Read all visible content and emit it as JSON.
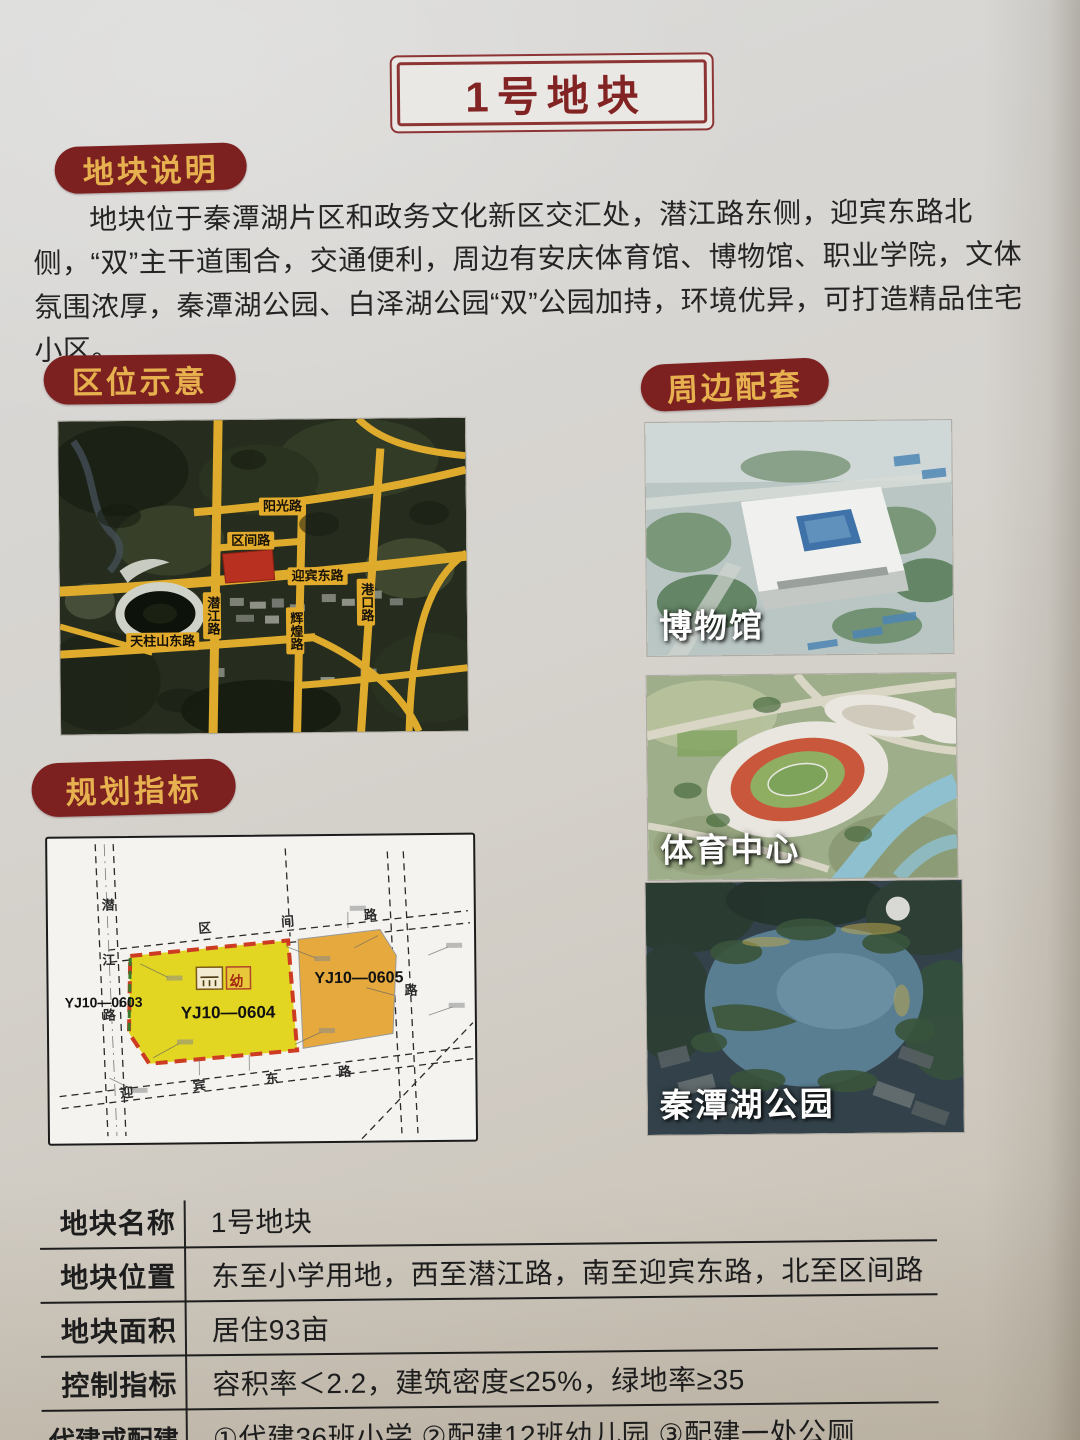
{
  "page_title": "1号地块",
  "sections": {
    "description": {
      "header": "地块说明",
      "body": "地块位于秦潭湖片区和政务文化新区交汇处，潜江路东侧，迎宾东路北侧，“双”主干道围合，交通便利，周边有安庆体育馆、博物馆、职业学院，文体氛围浓厚，秦潭湖公园、白泽湖公园“双”公园加持，环境优异，可打造精品住宅小区。"
    },
    "location": {
      "header": "区位示意",
      "map_labels": {
        "yangguang": "阳光路",
        "qujian": "区间路",
        "yingbin": "迎宾东路",
        "qianjiang": "潜江路",
        "huihuang": "辉煌路",
        "gangkou": "港口路",
        "tianzhushan": "天柱山东路"
      }
    },
    "surroundings": {
      "header": "周边配套",
      "items": [
        {
          "label": "博物馆"
        },
        {
          "label": "体育中心"
        },
        {
          "label": "秦潭湖公园"
        }
      ]
    },
    "planning": {
      "header": "规划指标",
      "map": {
        "parcel_left": "YJ10—0603",
        "parcel_main": "YJ10—0604",
        "parcel_right": "YJ10—0605",
        "kindergarten": "幼",
        "road_west": "潜江路",
        "road_north": "区间路",
        "road_south": "迎宾东路",
        "road_east_char": "路"
      }
    }
  },
  "table": {
    "rows": [
      {
        "label": "地块名称",
        "value": "1号地块"
      },
      {
        "label": "地块位置",
        "value": "东至小学用地，西至潜江路，南至迎宾东路，北至区间路"
      },
      {
        "label": "地块面积",
        "value": "居住93亩"
      },
      {
        "label": "控制指标",
        "value": "容积率＜2.2，建筑密度≤25%，绿地率≥35"
      },
      {
        "label": "代建或配建",
        "value": "①代建36班小学 ②配建12班幼儿园 ③配建一处公厕"
      }
    ]
  },
  "colors": {
    "header_pill_bg": "#7c2020",
    "header_pill_text": "#e6b14e",
    "title_text": "#822424",
    "target_parcel_red": "#b8301f",
    "road_yellow": "#e2ab2b",
    "parcel_yellow": "#e2d622",
    "parcel_orange": "#e5a93e"
  }
}
